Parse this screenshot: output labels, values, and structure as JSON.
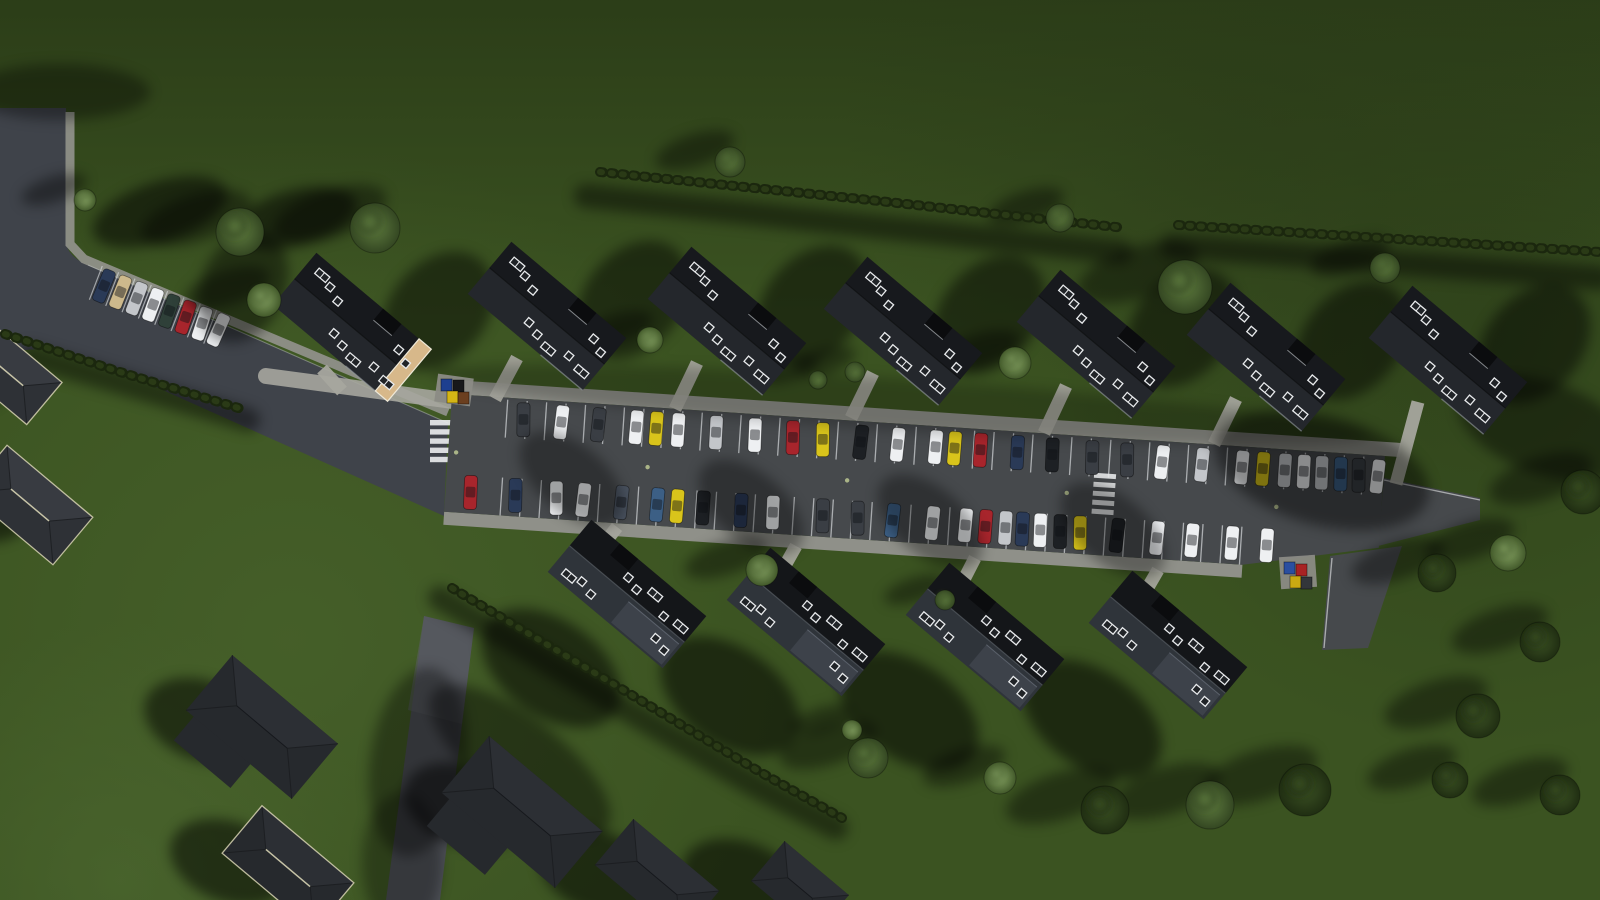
{
  "scene": {
    "description": "aerial-3d-render-residential-development-with-central-parking",
    "canvas": {
      "w": 1600,
      "h": 900
    }
  },
  "palette": {
    "grass_base": "#3b5321",
    "grass_top": "#2a3b17",
    "grass_light": "#4d682f",
    "grass_corner": "#506c33",
    "grass_dark1": "#263616",
    "grass_dark2": "#2a3a18",
    "road": "#3f434a",
    "lot": "#46494c",
    "road_bottom": "#4e5157",
    "road_bottom_hi": "#5a5d63",
    "sidewalk": "#8f9089",
    "walkway": "#a6a69e",
    "stall_line": "#d7dadc",
    "roof_dark": "#17191d",
    "roof_mid": "#24272c",
    "roof_lower_dark": "#141619",
    "roof_lower_mid": "#2f343a",
    "roof_inset": "#3d424a",
    "house_light": "#2e3136",
    "house_light2": "#383b41",
    "house_dark": "#26292d",
    "house_dark2": "#2c2f34",
    "trim": "#d8d4b4",
    "tan_wall": "#d7b88a",
    "hedge1": "#1b270e",
    "hedge2": "#2a3a16",
    "tree_light_hi": "#85a263",
    "tree_light_lo": "#42592a",
    "tree_mid_hi": "#5d7a3e",
    "tree_mid_lo": "#344722",
    "tree_dark_hi": "#3b5124",
    "tree_dark_lo": "#202e12",
    "car_colors": {
      "k": "#1d2024",
      "d": "#3a3e44",
      "w": "#eef0f2",
      "y": "#d9c41b",
      "r": "#a8252c",
      "s": "#c3c6ca",
      "b": "#3c5f85",
      "n": "#2a3a57",
      "l": "#4a5360",
      "t": "#cdb98c",
      "g": "#2f4039"
    }
  },
  "roads": {
    "entry_path": "M0,108 L66,108 L66,240 Q66,256 88,265 L448,423 L444,516 L100,362 Q45,340 0,356 Z",
    "entry_sidewalk": [
      [
        70,
        112
      ],
      [
        70,
        244
      ],
      [
        84,
        259
      ],
      [
        448,
        412
      ]
    ],
    "entry_edge_line": [
      [
        88,
        265
      ],
      [
        448,
        423
      ]
    ],
    "stub_poly": "1384,478 1480,498 1480,520 1378,546",
    "stub_edge": [
      [
        1384,
        480
      ],
      [
        1480,
        500
      ]
    ],
    "branch_poly": "1330,556 1402,546 1368,648 1322,650",
    "branch_edge": [
      [
        1332,
        558
      ],
      [
        1324,
        648
      ]
    ],
    "bottom_poly": "424,616 474,628 440,900 386,900",
    "bottom_hi_poly": "424,616 474,628 462,724 408,710",
    "crosswalk1": {
      "x": 430,
      "y": 420,
      "w": 24,
      "h": 5.4,
      "gap": 9.2,
      "n": 5
    },
    "b1_pad": [
      [
        266,
        376
      ],
      [
        460,
        402
      ]
    ]
  },
  "parking": {
    "origin": [
      452,
      394
    ],
    "angle": 3.8,
    "poly": "0,0 935,0 935,92 800,118 0,118",
    "top_sidewalk": [
      -12,
      -14,
      962,
      14
    ],
    "bottom_sidewalk": [
      0,
      118,
      800,
      13
    ],
    "stalls": {
      "start": 56,
      "pitch": 19.5,
      "count": 45,
      "top_band": [
        2,
        40
      ],
      "bottom_band": [
        80,
        118
      ]
    },
    "car_size": [
      13,
      34
    ],
    "row_y": {
      "top": 21,
      "bottom": 97
    },
    "crosswalk2": {
      "x": 646,
      "y": 36,
      "w": 22,
      "h": 5,
      "gap": 9,
      "n": 5
    },
    "lamps": [
      [
        8,
        58
      ],
      [
        200,
        60
      ],
      [
        400,
        60
      ],
      [
        620,
        58
      ],
      [
        830,
        58
      ]
    ],
    "top_cars": [
      [
        73,
        "d"
      ],
      [
        111,
        "w"
      ],
      [
        148,
        "d"
      ],
      [
        186,
        "w"
      ],
      [
        206,
        "y"
      ],
      [
        228,
        "w"
      ],
      [
        266,
        "s"
      ],
      [
        305,
        "w"
      ],
      [
        343,
        "r"
      ],
      [
        373,
        "y"
      ],
      [
        411,
        "k"
      ],
      [
        448,
        "w"
      ],
      [
        486,
        "w"
      ],
      [
        505,
        "y"
      ],
      [
        531,
        "r"
      ],
      [
        568,
        "n"
      ],
      [
        603,
        "k"
      ],
      [
        643,
        "d"
      ],
      [
        678,
        "d"
      ],
      [
        713,
        "w"
      ],
      [
        753,
        "s"
      ],
      [
        793,
        "w"
      ],
      [
        814,
        "y"
      ],
      [
        836,
        "s"
      ],
      [
        855,
        "w"
      ],
      [
        873,
        "s"
      ],
      [
        892,
        "b"
      ],
      [
        910,
        "d"
      ],
      [
        929,
        "w"
      ]
    ],
    "bottom_cars": [
      [
        25,
        "r"
      ],
      [
        70,
        "n"
      ],
      [
        111,
        "w"
      ],
      [
        138,
        "w"
      ],
      [
        176,
        "l"
      ],
      [
        212,
        "b"
      ],
      [
        232,
        "y"
      ],
      [
        258,
        "k"
      ],
      [
        296,
        "n"
      ],
      [
        328,
        "w"
      ],
      [
        378,
        "d"
      ],
      [
        413,
        "d"
      ],
      [
        448,
        "b"
      ],
      [
        488,
        "w"
      ],
      [
        521,
        "w"
      ],
      [
        541,
        "r"
      ],
      [
        561,
        "s"
      ],
      [
        578,
        "n"
      ],
      [
        596,
        "w"
      ],
      [
        616,
        "k"
      ],
      [
        636,
        "y"
      ],
      [
        673,
        "k"
      ],
      [
        713,
        "w"
      ],
      [
        748,
        "w"
      ],
      [
        788,
        "w"
      ],
      [
        823,
        "w"
      ]
    ]
  },
  "entry_parking": {
    "origin": [
      104,
      286
    ],
    "angle": 21,
    "pitch": 17.5,
    "car_size": [
      12.5,
      32
    ],
    "cars": [
      "n",
      "t",
      "s",
      "w",
      "g",
      "r",
      "w",
      "w"
    ]
  },
  "buildings": {
    "rotation": 40,
    "size": [
      150,
      68
    ],
    "upper_row": [
      [
        352,
        327
      ],
      [
        547,
        316
      ],
      [
        727,
        321
      ],
      [
        903,
        331
      ],
      [
        1096,
        344
      ],
      [
        1266,
        357
      ],
      [
        1448,
        360
      ]
    ],
    "lower_row": [
      [
        627,
        594
      ],
      [
        806,
        622
      ],
      [
        985,
        637
      ],
      [
        1168,
        645
      ]
    ],
    "tan_end_index": 0,
    "skylights_upper": {
      "singles": [
        [
          -46,
          -20
        ],
        [
          -31,
          -14
        ],
        [
          -13,
          13
        ],
        [
          1,
          17
        ],
        [
          47,
          -16
        ],
        [
          61,
          -10
        ],
        [
          39,
          13
        ]
      ],
      "doubles": [
        [
          -63,
          -24
        ],
        [
          15,
          21
        ],
        [
          55,
          17
        ]
      ]
    },
    "skylights_lower": {
      "singles": [
        [
          -46,
          16
        ],
        [
          -31,
          20
        ],
        [
          -13,
          -17
        ],
        [
          1,
          -13
        ],
        [
          47,
          12
        ],
        [
          61,
          16
        ],
        [
          39,
          -10
        ]
      ],
      "doubles": [
        [
          -63,
          20
        ],
        [
          15,
          -21
        ],
        [
          55,
          -13
        ]
      ]
    },
    "walkways_upper": [
      [
        [
          322,
          369
        ],
        [
          342,
          391
        ]
      ],
      [
        [
          517,
          358
        ],
        [
          495,
          399
        ]
      ],
      [
        [
          697,
          363
        ],
        [
          675,
          409
        ]
      ],
      [
        [
          873,
          373
        ],
        [
          851,
          418
        ]
      ],
      [
        [
          1066,
          386
        ],
        [
          1044,
          433
        ]
      ],
      [
        [
          1236,
          399
        ],
        [
          1214,
          444
        ]
      ],
      [
        [
          1418,
          402
        ],
        [
          1396,
          484
        ]
      ]
    ],
    "walkways_lower": [
      [
        [
          599,
          550
        ],
        [
          617,
          527
        ]
      ],
      [
        [
          778,
          578
        ],
        [
          796,
          546
        ]
      ],
      [
        [
          957,
          593
        ],
        [
          975,
          558
        ]
      ],
      [
        [
          1140,
          601
        ],
        [
          1158,
          570
        ]
      ]
    ]
  },
  "existing_houses": [
    {
      "c": [
        8,
        373
      ],
      "L": 95,
      "W": 55,
      "rot": 40,
      "trim": true,
      "tone": "light"
    },
    {
      "c": [
        30,
        505
      ],
      "L": 112,
      "W": 62,
      "rot": 40,
      "trim": true,
      "tone": "light"
    },
    {
      "c": [
        262,
        727
      ],
      "L": 138,
      "W": 72,
      "rot": 40,
      "trim": false,
      "tone": "dark",
      "wing": [
        -22,
        30,
        74
      ]
    },
    {
      "c": [
        288,
        868
      ],
      "L": 120,
      "W": 62,
      "rot": 40,
      "trim": true,
      "tone": "dark"
    },
    {
      "c": [
        522,
        812
      ],
      "L": 148,
      "W": 74,
      "rot": 40,
      "trim": false,
      "tone": "dark",
      "wing": [
        -26,
        34,
        76
      ]
    },
    {
      "c": [
        657,
        878
      ],
      "L": 112,
      "W": 60,
      "rot": 40,
      "trim": false,
      "tone": "dark"
    },
    {
      "c": [
        800,
        888
      ],
      "L": 84,
      "W": 52,
      "rot": 40,
      "trim": false,
      "tone": "dark"
    }
  ],
  "hedges": [
    {
      "path": "M600,172 L870,200 L1125,228"
    },
    {
      "path": "M1178,225 L1600,252"
    },
    {
      "path": "M5,334 L120,372 L245,410"
    },
    {
      "path": "M452,588 L610,682 L760,772 L842,818"
    }
  ],
  "trees": [
    [
      85,
      200,
      11,
      "light"
    ],
    [
      240,
      232,
      24,
      "mid"
    ],
    [
      375,
      228,
      25,
      "mid"
    ],
    [
      264,
      300,
      17,
      "light"
    ],
    [
      730,
      162,
      15,
      "mid"
    ],
    [
      1060,
      218,
      14,
      "mid"
    ],
    [
      650,
      340,
      13,
      "light"
    ],
    [
      818,
      380,
      9,
      "mid"
    ],
    [
      855,
      372,
      10,
      "mid"
    ],
    [
      1015,
      363,
      16,
      "light"
    ],
    [
      1185,
      287,
      27,
      "mid"
    ],
    [
      1385,
      268,
      15,
      "mid"
    ],
    [
      762,
      570,
      16,
      "light"
    ],
    [
      945,
      600,
      10,
      "mid"
    ],
    [
      852,
      730,
      10,
      "light"
    ],
    [
      868,
      758,
      20,
      "mid"
    ],
    [
      1000,
      778,
      16,
      "light"
    ],
    [
      1105,
      810,
      24,
      "dark"
    ],
    [
      1210,
      805,
      24,
      "mid"
    ],
    [
      1305,
      790,
      26,
      "dark"
    ],
    [
      1450,
      780,
      18,
      "dark"
    ],
    [
      1560,
      795,
      20,
      "dark"
    ],
    [
      1583,
      492,
      22,
      "dark"
    ],
    [
      1508,
      553,
      18,
      "light"
    ],
    [
      1437,
      573,
      19,
      "dark"
    ],
    [
      1540,
      642,
      20,
      "dark"
    ],
    [
      1478,
      716,
      22,
      "dark"
    ]
  ],
  "shadows": {
    "blobs": [
      [
        160,
        212,
        70,
        30,
        -18,
        0.5
      ],
      [
        296,
        218,
        62,
        28,
        -15,
        0.5
      ],
      [
        243,
        287,
        42,
        58,
        25,
        0.42
      ],
      [
        60,
        92,
        90,
        28,
        0,
        0.35
      ],
      [
        1322,
        470,
        110,
        55,
        15,
        0.42
      ],
      [
        1545,
        428,
        92,
        46,
        20,
        0.4
      ],
      [
        418,
        762,
        48,
        95,
        8,
        0.35
      ],
      [
        402,
        862,
        40,
        70,
        0,
        0.3
      ],
      [
        520,
        760,
        110,
        42,
        38,
        0.4
      ],
      [
        900,
        405,
        470,
        26,
        3.8,
        0.22
      ]
    ],
    "hedge_shadow_paths": [
      "M586,196 L870,226 L1120,252",
      "M1172,246 L1600,278",
      "M30,356 L248,420",
      "M440,598 L600,694 L752,784 L836,828"
    ],
    "upper_building_offset": [
      86,
      -16,
      48,
      66,
      40,
      0.45
    ],
    "lower_building_offsets": [
      [
        -76,
        74,
        78,
        48,
        35,
        0.5
      ],
      [
        -55,
        -115,
        62,
        34,
        40,
        0.33
      ]
    ],
    "house_offset": [
      -58,
      -6,
      62,
      40,
      20,
      0.5
    ],
    "tree_auto": {
      "dx_extra": 20,
      "dy_factor": 0.25,
      "rx_mul": 1.8,
      "rx_add": 14,
      "ry_mul": 0.8,
      "ry_add": 4,
      "rot": -18,
      "opacity": 0.38
    }
  },
  "bins": [
    {
      "pad": [
        436,
        376,
        36,
        28,
        8
      ],
      "items": [
        [
          441,
          379,
          "#1d3f8f"
        ],
        [
          453,
          380,
          "#17181a"
        ],
        [
          447,
          391,
          "#d4b515"
        ],
        [
          458,
          392,
          "#6b3f1f"
        ]
      ]
    },
    {
      "pad": [
        1280,
        556,
        36,
        32,
        -4
      ],
      "items": [
        [
          1284,
          562,
          "#2b4fa0"
        ],
        [
          1296,
          564,
          "#a82323"
        ],
        [
          1290,
          576,
          "#c9a912"
        ],
        [
          1301,
          577,
          "#33363a"
        ]
      ]
    }
  ]
}
